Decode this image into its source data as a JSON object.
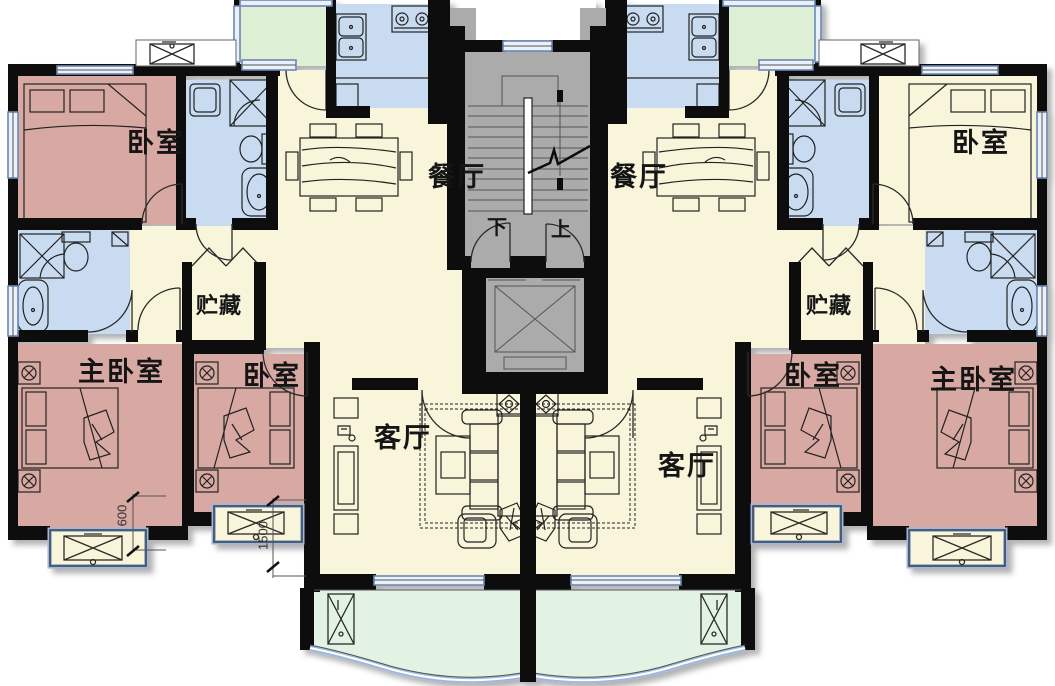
{
  "palette": {
    "wall": "#0d0d0d",
    "pink": "#d7a9a2",
    "blue": "#c9dbf0",
    "cream": "#f8f5da",
    "green_top": "#ddefd5",
    "green_bottom": "#e2f3e3",
    "gray": "#ababab",
    "frame": "#6e88b4",
    "frame_light": "#9db8dd",
    "bedtop_right_fill": "#f8f5da"
  },
  "rooms": {
    "bedroom": "卧室",
    "master_bedroom": "主卧室",
    "dining": "餐厅",
    "living": "客厅",
    "storage": "贮藏"
  },
  "stairs": {
    "down": "下",
    "up": "上"
  },
  "dimensions": {
    "bay_offset": "600",
    "bay_width": "1500"
  }
}
